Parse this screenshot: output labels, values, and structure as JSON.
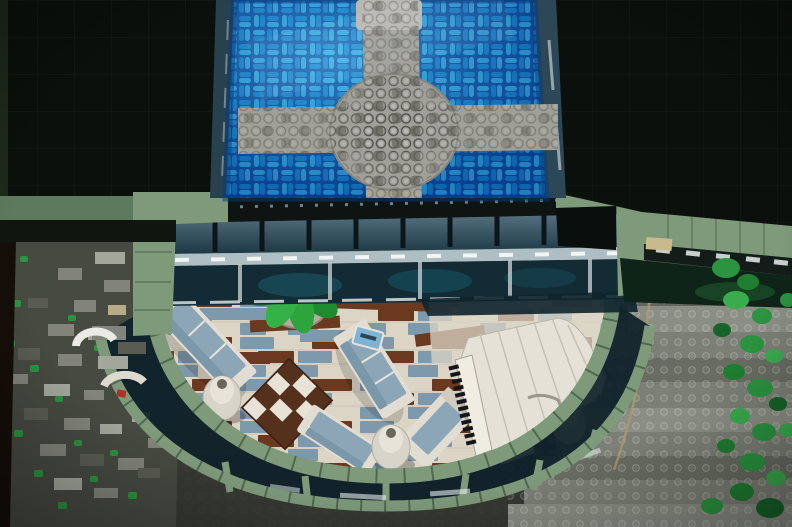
{
  "meta": {
    "caption": "Top-down photograph of a LEGO model: rooftop swimming pool of translucent blue tiles crossed by a grey studded walkway with a round hub, above a glass-walled lounge with a curved sand-green balcony furnished with blue-grey sofas, a brown coffee table, white cone floor lamps, a potted green plant and a white grand piano; grey rocky LEGO terrain with green foliage surrounds the building"
  },
  "scene": {
    "elements": [
      "black-tiled-roof-left",
      "black-tiled-roof-right",
      "rooftop-pool",
      "walkway-cross",
      "walkway-hub",
      "glass-curtain-wall",
      "silver-ledge",
      "sand-green-pillar",
      "sand-green-roof-trim",
      "terrace-floor",
      "potted-plant",
      "sofa-upper-left",
      "sofa-center",
      "sofa-lower",
      "lounge-chair",
      "coffee-table",
      "floor-lamp-1",
      "floor-lamp-2",
      "floor-lamp-3",
      "grand-piano",
      "piano-bench",
      "balcony-inner-wall",
      "balcony-outer-railing",
      "balcony-glass-panels",
      "rock-terrain-left",
      "stud-plate-terrain-right",
      "foliage-right",
      "white-dish-pieces",
      "red-brick-accent"
    ]
  },
  "palette": {
    "photoBg": "#150e08",
    "roofBlack": "#0b100c",
    "sandGreen": "#7e9a7b",
    "sandGreenDeep": "#5f7c60",
    "poolBlue": "#1181cc",
    "poolBlueLight": "#2ba6e2",
    "poolBlueDeep": "#0a4fa2",
    "poolEdgeTeal": "#27424e",
    "pathGray": "#a0a099",
    "pathGrayDark": "#7c7c75",
    "glassSteel": "#3f5d6c",
    "glassDeep": "#122b35",
    "glassSilver": "#aebec2",
    "railGlass": "#0e2129",
    "floorWhite": "#dcd5c6",
    "floorBlue": "#7e98ac",
    "floorBrown": "#6a3920",
    "floorTan": "#bfae85",
    "sofaBlue": "#8ca6b8",
    "sofaWhite": "#e2ddd2",
    "tableBrown": "#55301c",
    "pianoWhite": "#e6e1d6",
    "lampWhite": "#d9d4c9",
    "leafGreen": "#2da43c",
    "leafGreenDark": "#1d8b2e",
    "potSilver": "#b5ad9c",
    "rockBase": "#3e4039",
    "rockGray": "#82847b",
    "rockGrayLight": "#a3a69b",
    "rockGrayDark": "#5a5c53",
    "plateMid": "#7c7f75",
    "plateDark": "#696c62",
    "plateLight": "#8b8e84",
    "foliage": "#2a9440",
    "accentRed": "#b03022"
  }
}
